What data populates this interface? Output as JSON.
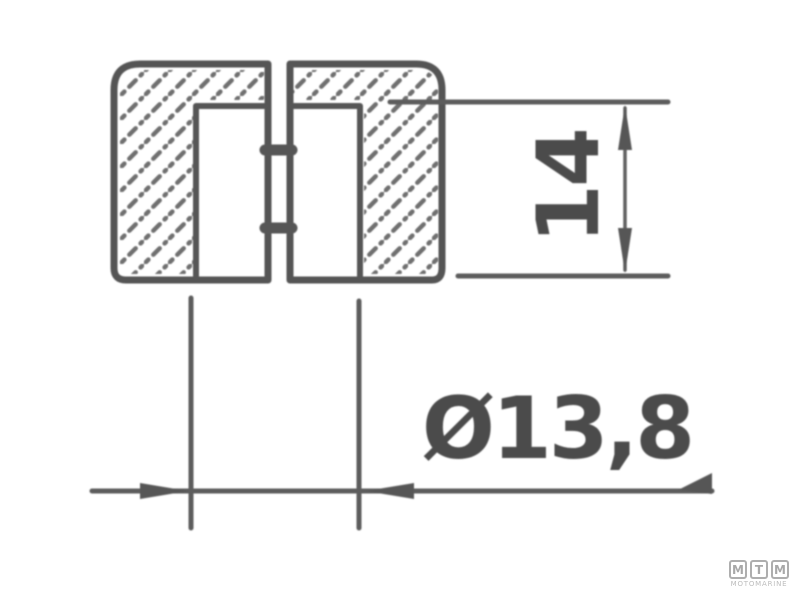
{
  "drawing": {
    "description_visible_text_only": "",
    "height_dimension": {
      "label": "14",
      "value": 14,
      "orientation": "vertical"
    },
    "diameter_dimension": {
      "label": "Ø13,8",
      "value": 13.8,
      "orientation": "horizontal"
    }
  },
  "logo": {
    "letters": [
      "M",
      "T",
      "M"
    ],
    "name": "MOTOMARINE"
  },
  "colors": {
    "background": "#ffffff",
    "outline_stroke": "#545454",
    "dimension_stroke": "#5d5d5d",
    "dimension_text": "#4c4c4c",
    "hatch_stroke": "#6f6f6f",
    "logo_gray": "#aeaeae"
  }
}
